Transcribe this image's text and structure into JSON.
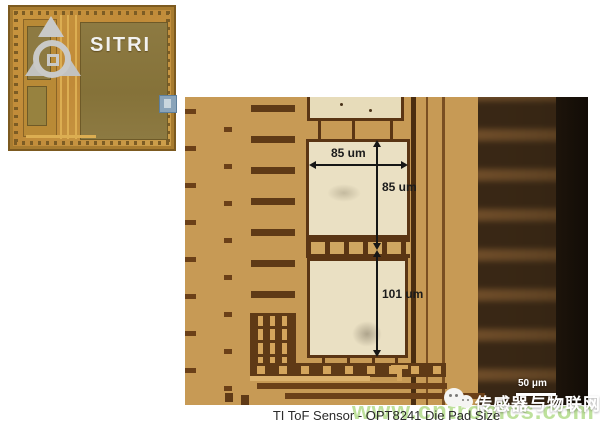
{
  "inset": {
    "logo_text": "SITRI"
  },
  "annotations": {
    "pad1_width": "85 um",
    "pad1_height": "85 um",
    "pad2_height": "101 um",
    "scale_bar": "50 μm"
  },
  "caption": "TI ToF Sensor - OPT8241 Die Pad Size",
  "watermarks": {
    "wechat_account": "传感器与物联网",
    "site_url": "www.cntronics.com"
  },
  "colors": {
    "micrograph_background": "#c79a55",
    "pad_cream": "#eae0c3",
    "trace_brown": "#5f3a16",
    "die_gold": "#c9963f",
    "die_block_olive": "#8d7a42",
    "logo_silver": "#c9c9c7",
    "watermark_green": "#96ce5f",
    "annotation_black": "#161616"
  }
}
